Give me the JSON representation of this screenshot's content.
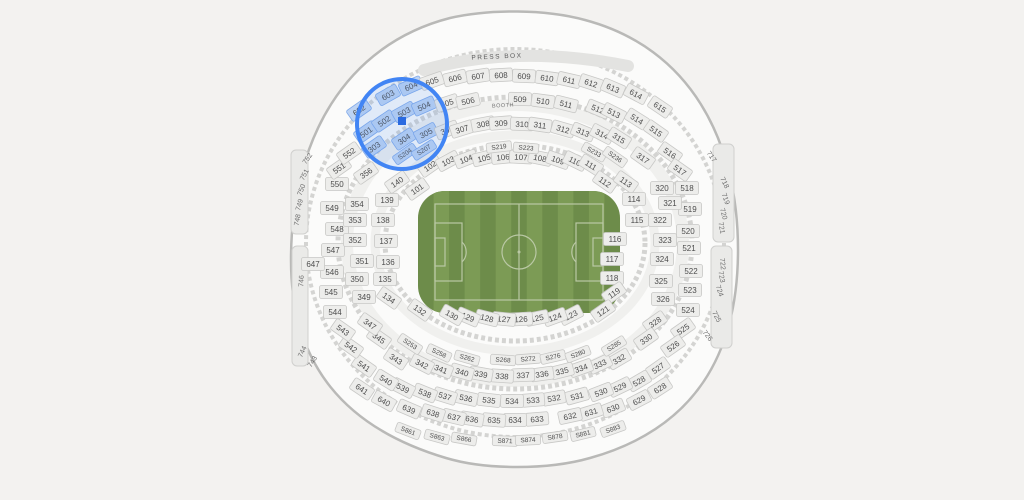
{
  "map": {
    "press_box_label": "PRESS BOX",
    "booth_label": "BOOTH",
    "colors": {
      "page_bg": "#f3f2f0",
      "bowl_fill": "#fbfbfa",
      "bowl_stroke": "#b9b9b7",
      "tier_ring": "#f0f0ee",
      "dashed_ring": "#d4d4d2",
      "edge_block_fill": "#eaeae8",
      "edge_block_stroke": "#d0d0ce",
      "press_band": "#e3e3e1",
      "press_text": "#5a5a5a",
      "chip_fill": "#ededeb",
      "chip_stroke": "#c8c8c6",
      "chip_text": "#4d4d4d",
      "bare_text": "#6e6e6e",
      "highlight_chip_fill": "#bdd3f3",
      "highlight_chip_stroke": "#82abea",
      "highlight_ring": "#4285f4",
      "highlight_fill": "#4285f4",
      "marker_blue": "#2a6ae0",
      "field_dark": "#6d8c4a",
      "field_light": "#7c9b55",
      "field_line": "#bac8a5"
    },
    "highlight": {
      "cx": 402,
      "cy": 124,
      "r": 45,
      "marker_x": 402,
      "marker_y": 121,
      "marker_size": 8
    },
    "sections": [
      [
        "602",
        359,
        110,
        "h"
      ],
      [
        "603",
        388,
        95,
        "h"
      ],
      [
        "604",
        411,
        86,
        "h"
      ],
      [
        "605",
        432,
        81
      ],
      [
        "606",
        455,
        78
      ],
      [
        "607",
        478,
        76
      ],
      [
        "608",
        501,
        75
      ],
      [
        "609",
        524,
        76
      ],
      [
        "610",
        547,
        78
      ],
      [
        "611",
        569,
        80
      ],
      [
        "612",
        591,
        83
      ],
      [
        "613",
        613,
        88
      ],
      [
        "614",
        636,
        94
      ],
      [
        "615",
        660,
        107
      ],
      [
        "501",
        366,
        132,
        "h"
      ],
      [
        "502",
        384,
        121,
        "h"
      ],
      [
        "503",
        404,
        112,
        "h"
      ],
      [
        "504",
        424,
        106,
        "h"
      ],
      [
        "505",
        447,
        103
      ],
      [
        "506",
        468,
        101
      ],
      [
        "509",
        520,
        99
      ],
      [
        "510",
        543,
        101
      ],
      [
        "511",
        566,
        104
      ],
      [
        "512",
        598,
        109
      ],
      [
        "513",
        614,
        113
      ],
      [
        "514",
        637,
        119
      ],
      [
        "515",
        656,
        131
      ],
      [
        "516",
        670,
        153
      ],
      [
        "517",
        680,
        170
      ],
      [
        "518",
        687,
        188
      ],
      [
        "519",
        690,
        209
      ],
      [
        "520",
        688,
        231
      ],
      [
        "521",
        689,
        248
      ],
      [
        "522",
        691,
        271
      ],
      [
        "523",
        690,
        290
      ],
      [
        "524",
        688,
        310
      ],
      [
        "525",
        683,
        329
      ],
      [
        "526",
        673,
        346
      ],
      [
        "527",
        658,
        368
      ],
      [
        "528",
        639,
        381
      ],
      [
        "529",
        620,
        387
      ],
      [
        "530",
        601,
        392
      ],
      [
        "531",
        577,
        396
      ],
      [
        "532",
        554,
        398
      ],
      [
        "533",
        533,
        400
      ],
      [
        "534",
        512,
        401
      ],
      [
        "535",
        489,
        400
      ],
      [
        "536",
        466,
        398
      ],
      [
        "537",
        445,
        396
      ],
      [
        "538",
        425,
        393
      ],
      [
        "539",
        403,
        388
      ],
      [
        "540",
        386,
        380
      ],
      [
        "541",
        364,
        366
      ],
      [
        "542",
        351,
        347
      ],
      [
        "543",
        343,
        330
      ],
      [
        "544",
        335,
        312
      ],
      [
        "545",
        331,
        292
      ],
      [
        "546",
        332,
        272
      ],
      [
        "547",
        333,
        250
      ],
      [
        "548",
        337,
        229
      ],
      [
        "549",
        332,
        208
      ],
      [
        "550",
        337,
        184
      ],
      [
        "551",
        339,
        168
      ],
      [
        "552",
        349,
        153
      ],
      [
        "303",
        374,
        147,
        "h"
      ],
      [
        "304",
        404,
        139,
        "h"
      ],
      [
        "305",
        426,
        133,
        "h"
      ],
      [
        "306",
        447,
        130
      ],
      [
        "307",
        462,
        129
      ],
      [
        "308",
        483,
        124
      ],
      [
        "309",
        501,
        123
      ],
      [
        "310",
        522,
        124
      ],
      [
        "311",
        540,
        125
      ],
      [
        "312",
        563,
        129
      ],
      [
        "313",
        583,
        132
      ],
      [
        "314",
        602,
        134
      ],
      [
        "315",
        619,
        138
      ],
      [
        "317",
        643,
        158
      ],
      [
        "320",
        662,
        188
      ],
      [
        "321",
        670,
        203
      ],
      [
        "322",
        660,
        220
      ],
      [
        "323",
        665,
        240
      ],
      [
        "324",
        662,
        259
      ],
      [
        "325",
        661,
        281
      ],
      [
        "326",
        663,
        299
      ],
      [
        "328",
        655,
        322
      ],
      [
        "330",
        646,
        339
      ],
      [
        "332",
        619,
        359
      ],
      [
        "333",
        600,
        364
      ],
      [
        "334",
        581,
        368
      ],
      [
        "335",
        562,
        371
      ],
      [
        "336",
        542,
        374
      ],
      [
        "337",
        523,
        375
      ],
      [
        "338",
        502,
        376
      ],
      [
        "339",
        481,
        374
      ],
      [
        "340",
        462,
        372
      ],
      [
        "341",
        441,
        369
      ],
      [
        "342",
        422,
        364
      ],
      [
        "343",
        396,
        359
      ],
      [
        "345",
        379,
        338
      ],
      [
        "347",
        370,
        324
      ],
      [
        "349",
        364,
        297
      ],
      [
        "350",
        357,
        279
      ],
      [
        "351",
        362,
        261
      ],
      [
        "352",
        355,
        240
      ],
      [
        "353",
        355,
        220
      ],
      [
        "354",
        357,
        204
      ],
      [
        "356",
        366,
        173
      ],
      [
        "101",
        417,
        189
      ],
      [
        "102",
        430,
        166
      ],
      [
        "103",
        448,
        161
      ],
      [
        "104",
        466,
        159
      ],
      [
        "105",
        484,
        158
      ],
      [
        "106",
        503,
        157
      ],
      [
        "107",
        521,
        157
      ],
      [
        "108",
        540,
        158
      ],
      [
        "109",
        558,
        160
      ],
      [
        "110",
        575,
        161
      ],
      [
        "111",
        591,
        165
      ],
      [
        "112",
        605,
        182
      ],
      [
        "113",
        626,
        182
      ],
      [
        "114",
        634,
        199
      ],
      [
        "115",
        637,
        220
      ],
      [
        "116",
        615,
        239
      ],
      [
        "117",
        612,
        259
      ],
      [
        "118",
        612,
        278
      ],
      [
        "119",
        614,
        293
      ],
      [
        "121",
        603,
        311
      ],
      [
        "123",
        571,
        315
      ],
      [
        "124",
        555,
        317
      ],
      [
        "125",
        537,
        318
      ],
      [
        "126",
        521,
        319
      ],
      [
        "127",
        504,
        319
      ],
      [
        "128",
        487,
        318
      ],
      [
        "129",
        468,
        317
      ],
      [
        "130",
        452,
        315
      ],
      [
        "132",
        420,
        310
      ],
      [
        "134",
        389,
        298
      ],
      [
        "135",
        385,
        279
      ],
      [
        "136",
        388,
        262
      ],
      [
        "137",
        386,
        241
      ],
      [
        "138",
        383,
        220
      ],
      [
        "139",
        387,
        200
      ],
      [
        "140",
        397,
        182
      ],
      [
        "647",
        313,
        264
      ],
      [
        "628",
        660,
        388
      ],
      [
        "629",
        639,
        400
      ],
      [
        "630",
        613,
        408
      ],
      [
        "631",
        591,
        412
      ],
      [
        "632",
        570,
        416
      ],
      [
        "633",
        537,
        419
      ],
      [
        "634",
        515,
        420
      ],
      [
        "635",
        494,
        420
      ],
      [
        "636",
        472,
        419
      ],
      [
        "637",
        454,
        417
      ],
      [
        "638",
        433,
        413
      ],
      [
        "639",
        409,
        409
      ],
      [
        "640",
        384,
        401
      ],
      [
        "641",
        362,
        389
      ],
      [
        "S204",
        405,
        154,
        "h"
      ],
      [
        "S207",
        424,
        150,
        "h"
      ],
      [
        "S219",
        499,
        147
      ],
      [
        "S223",
        526,
        148
      ],
      [
        "S233",
        594,
        152
      ],
      [
        "S236",
        615,
        157
      ],
      [
        "S253",
        410,
        344
      ],
      [
        "S258",
        439,
        353
      ],
      [
        "S262",
        467,
        358
      ],
      [
        "S268",
        503,
        360
      ],
      [
        "S272",
        528,
        359
      ],
      [
        "S276",
        553,
        357
      ],
      [
        "S280",
        578,
        354
      ],
      [
        "S285",
        614,
        346
      ],
      [
        "S861",
        408,
        431
      ],
      [
        "S863",
        437,
        437
      ],
      [
        "S866",
        464,
        439
      ],
      [
        "S871",
        505,
        441
      ],
      [
        "S874",
        528,
        440
      ],
      [
        "S878",
        555,
        437
      ],
      [
        "S881",
        583,
        434
      ],
      [
        "S883",
        613,
        429
      ],
      [
        "752",
        308,
        159,
        -55
      ],
      [
        "751",
        305,
        175,
        -62
      ],
      [
        "750",
        302,
        190,
        -70
      ],
      [
        "749",
        300,
        205,
        -75
      ],
      [
        "748",
        298,
        220,
        -80
      ],
      [
        "746",
        302,
        281,
        -88
      ],
      [
        "744",
        303,
        352,
        -65
      ],
      [
        "743",
        313,
        362,
        -58
      ],
      [
        "717",
        711,
        157,
        55
      ],
      [
        "718",
        724,
        183,
        65
      ],
      [
        "719",
        725,
        199,
        70
      ],
      [
        "720",
        723,
        214,
        75
      ],
      [
        "721",
        721,
        228,
        80
      ],
      [
        "722",
        722,
        264,
        85
      ],
      [
        "723",
        721,
        277,
        80
      ],
      [
        "724",
        719,
        291,
        72
      ],
      [
        "725",
        716,
        317,
        62
      ],
      [
        "726",
        707,
        336,
        52
      ]
    ]
  }
}
